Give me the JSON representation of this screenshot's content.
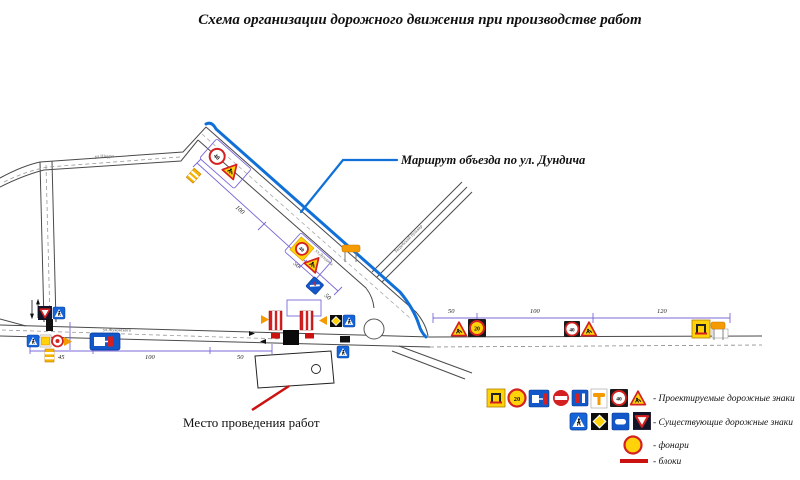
{
  "title": "Схема организации дорожного движения при производстве работ",
  "annotations": {
    "detour_route_label": "Маршрут объезда по ул. Дундича",
    "work_site_label": "Место проведения работ"
  },
  "streets": {
    "top_street": "ул.Шкуро",
    "bottom_street": "ул.Жуковского",
    "detour_street": "ул.Дундича",
    "secondary_street": "Загребский бульвар"
  },
  "dimensions": {
    "detour_seg1": "100",
    "detour_seg2": "50",
    "detour_seg3": "50",
    "left_seg1": "45",
    "left_seg2": "100",
    "left_seg3": "50",
    "right_seg1": "50",
    "right_seg2": "100",
    "right_seg3": "120"
  },
  "sign_values": {
    "speed_limit_20": "20",
    "speed_limit_40": "40"
  },
  "legend": {
    "projected_signs": "- Проектируемые дорожные знаки",
    "existing_signs": "- Существующие дорожные знаки",
    "lanterns": "- фонари",
    "blocks": "- блоки"
  },
  "colors": {
    "route_blue": "#1070d8",
    "dimension_violet": "#7b68d8",
    "block_red": "#cc1111",
    "sign_yellow": "#ffd20a",
    "lantern_orange": "#f59a00"
  }
}
